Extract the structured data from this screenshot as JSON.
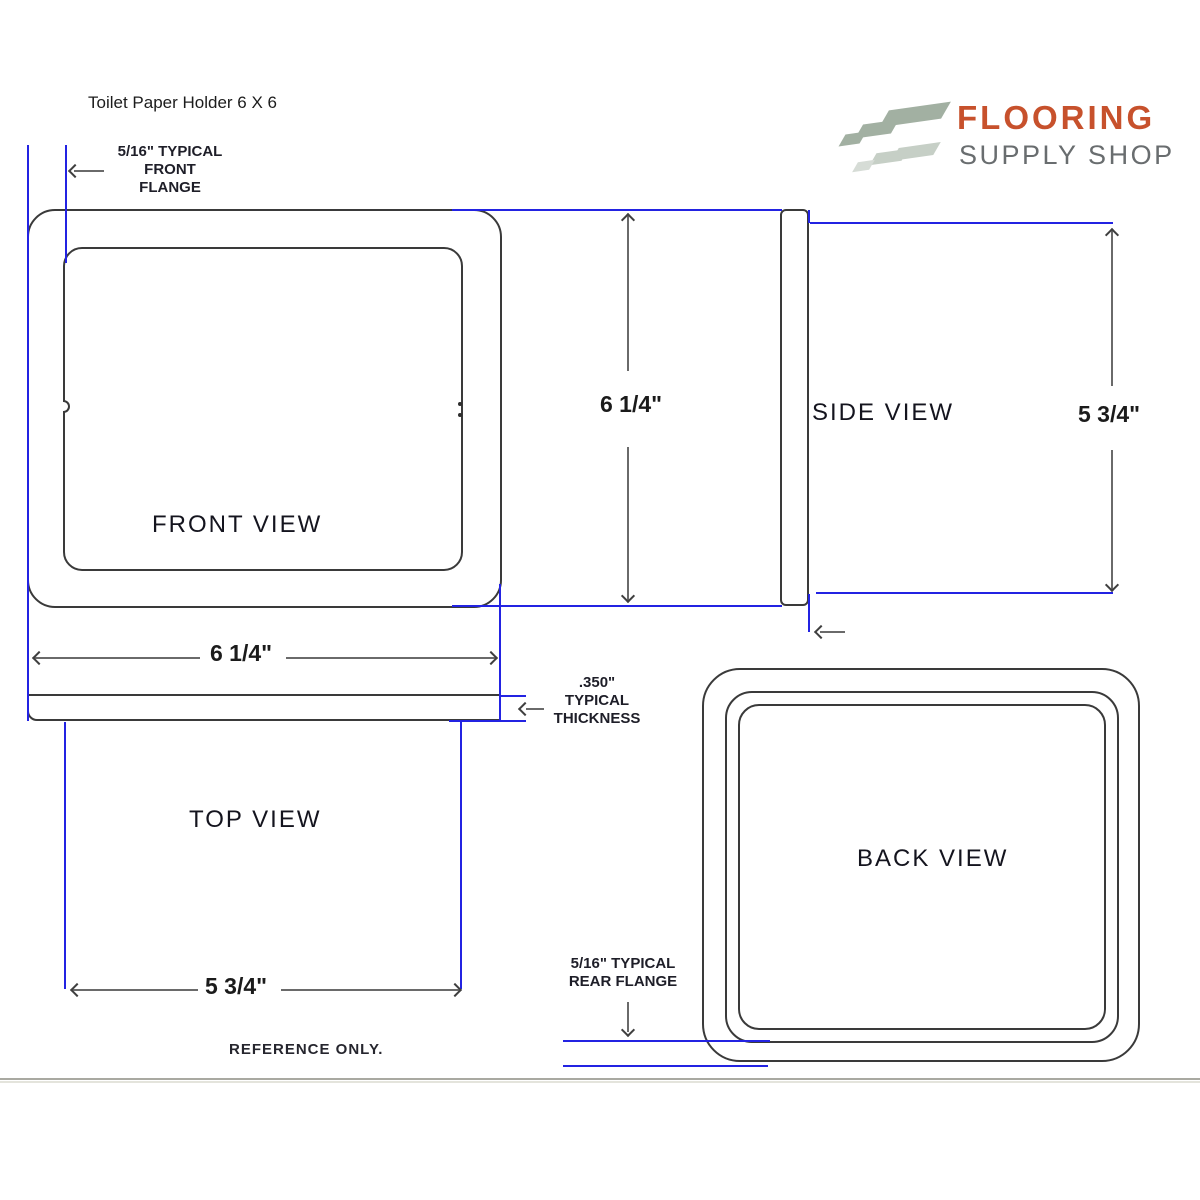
{
  "page": {
    "title": "Toilet Paper Holder 6 X 6",
    "reference_note": "REFERENCE ONLY."
  },
  "brand": {
    "name_line1": "FLOORING",
    "name_line2": "SUPPLY SHOP",
    "name_line1_color": "#c7512c",
    "name_line2_color": "#696d6f",
    "tiles_icon": "diagonal-flooring-planks-icon",
    "tile_color_dark": "#a2b0a2",
    "tile_color_light": "#c6cfc6"
  },
  "views": {
    "front": {
      "label": "FRONT VIEW"
    },
    "side": {
      "label": "SIDE VIEW"
    },
    "top": {
      "label": "TOP VIEW"
    },
    "back": {
      "label": "BACK VIEW"
    }
  },
  "dimensions": {
    "front_height": "6 1/4\"",
    "front_width": "6 1/4\"",
    "side_height": "5 3/4\"",
    "top_depth": "5 3/4\"",
    "front_flange_line1": "5/16\" TYPICAL",
    "front_flange_line2": "FRONT",
    "front_flange_line3": "FLANGE",
    "thickness_line1": ".350\"",
    "thickness_line2": "TYPICAL",
    "thickness_line3": "THICKNESS",
    "rear_flange_line1": "5/16\" TYPICAL",
    "rear_flange_line2": "REAR FLANGE"
  },
  "colors": {
    "extension_line_blue": "#2323e2",
    "drawing_line": "#3a3a3a",
    "dimension_gray": "#6a6a6a"
  }
}
